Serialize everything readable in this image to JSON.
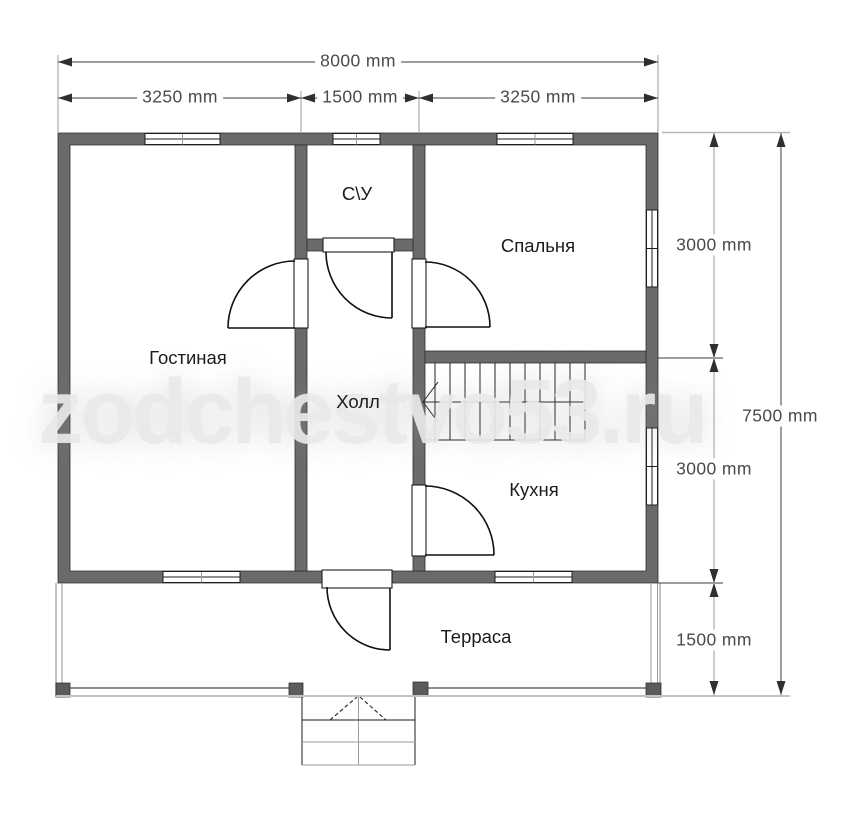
{
  "plan": {
    "watermark": "zodchestvo53.ru",
    "rooms": [
      {
        "id": "living",
        "label": "Гостиная"
      },
      {
        "id": "hall",
        "label": "Холл"
      },
      {
        "id": "bathroom",
        "label": "С\\У"
      },
      {
        "id": "bedroom",
        "label": "Спальня"
      },
      {
        "id": "kitchen",
        "label": "Кухня"
      },
      {
        "id": "terrace",
        "label": "Терраса"
      }
    ],
    "dimensions": {
      "total_width": "8000 mm",
      "top_segments": [
        "3250 mm",
        "1500 mm",
        "3250 mm"
      ],
      "right_segments": [
        "3000 mm",
        "3000 mm",
        "1500 mm"
      ],
      "total_height": "7500 mm"
    },
    "colors": {
      "wall": "#6a6a6a",
      "outline": "#1d1d1d",
      "extension_line": "#b8b8b8",
      "dimension_text": "#4a4a4a",
      "watermark": "#e9e9e9"
    }
  }
}
